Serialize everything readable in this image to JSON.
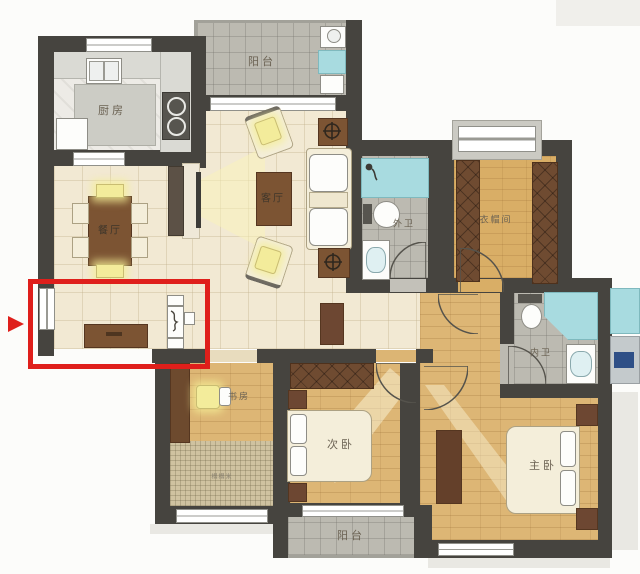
{
  "title": "apartment-floor-plan",
  "rooms": {
    "balcony_top": {
      "label": "阳台"
    },
    "kitchen": {
      "label": "厨房"
    },
    "dining": {
      "label": "餐厅"
    },
    "living": {
      "label": "客厅"
    },
    "bath_outer": {
      "label": "外卫"
    },
    "cloakroom": {
      "label": "衣帽间"
    },
    "bath_inner": {
      "label": "内卫"
    },
    "study": {
      "label": "书房"
    },
    "bedroom_second": {
      "label": "次卧"
    },
    "bedroom_master": {
      "label": "主卧"
    },
    "balcony_bottom": {
      "label": "阳台"
    },
    "tatami_area": {
      "label": "榻榻米"
    }
  },
  "annotation": {
    "highlight": "entry-area-red-box",
    "pointer": "red-arrow-left-edge",
    "color": "#df1f1b"
  },
  "colors": {
    "wall": "#46443f",
    "tile_beige": "#f2e9d3",
    "tile_gray": "#bcbab1",
    "wood_floor": "#ddb675",
    "furniture_brown": "#7c5433",
    "fixture_teal": "#a8dbe0",
    "annotation_red": "#df1f1b"
  }
}
